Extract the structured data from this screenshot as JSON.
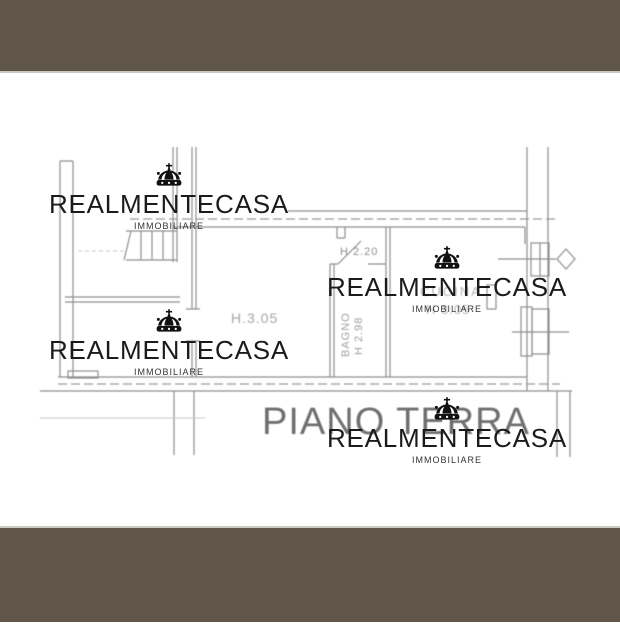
{
  "brand": {
    "name": "REALMENTECASA",
    "tagline": "IMMOBILIARE"
  },
  "floor_plan": {
    "title": "PIANO TERRA",
    "labels": {
      "hallway_height": "H 2.20",
      "left_room_height": "H.3.05",
      "bathroom_name": "BAGNO",
      "bathroom_height": "H 2.98",
      "kitchen_name": "CUCINA",
      "kitchen_height": "H 3.05"
    }
  },
  "colors": {
    "frame_brown": "#5f5548",
    "separator_light": "#ccc8c1",
    "plan_line_gray": "#8e8e8e",
    "label_gray": "#9e9e9e",
    "kitchen_label_gray": "#b5b5b5",
    "title_gray": "#6f6f6f",
    "watermark_black": "#1b1b1b",
    "background": "#ffffff"
  }
}
